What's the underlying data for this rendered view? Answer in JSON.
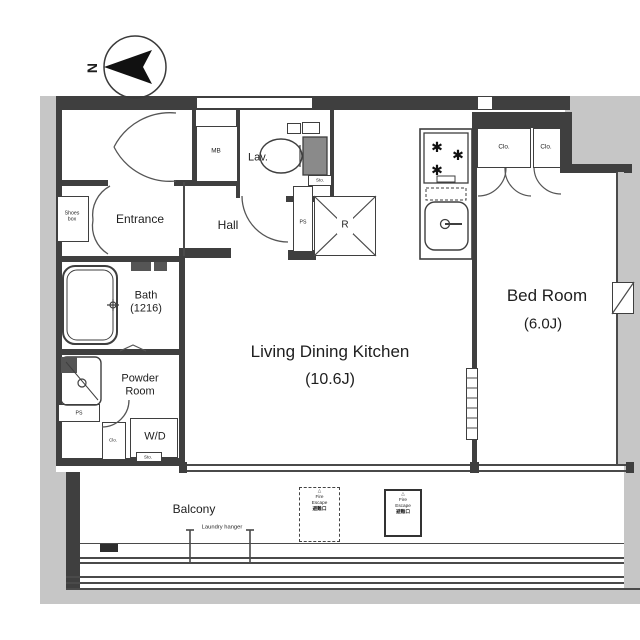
{
  "north": {
    "label": "N"
  },
  "rooms": {
    "entrance": "Entrance",
    "hall": "Hall",
    "lav": "Lav.",
    "mb": "MB",
    "shoes_box": [
      "Shoes",
      "box"
    ],
    "bath": [
      "Bath",
      "(1216)"
    ],
    "powder_room": [
      "Powder",
      "Room"
    ],
    "wd": "W/D",
    "ldk": [
      "Living Dining Kitchen",
      "(10.6J)"
    ],
    "bedroom": [
      "Bed Room",
      "(6.0J)"
    ],
    "balcony": "Balcony",
    "laundry_hanger": "Laundry hanger",
    "refrigerator": "R",
    "ps_hall": "PS",
    "ps_powder": "PS",
    "closet_left": "Clo.",
    "closet_right": "Clo.",
    "closet_powder": "Clo.",
    "storage_wd": "Sto.",
    "storage_lav": "Sto."
  },
  "fire_escape_left": {
    "mark": "△",
    "line1": "Fire",
    "line2": "Escape",
    "line3": "避難口"
  },
  "fire_escape_right": {
    "mark": "△",
    "line1": "Fire",
    "line2": "Escape",
    "line3": "避難口"
  },
  "colors": {
    "wall": "#3f3f3f",
    "exterior": "#c6c6c6",
    "line": "#4a4a4a",
    "text": "#1e1e1e"
  }
}
